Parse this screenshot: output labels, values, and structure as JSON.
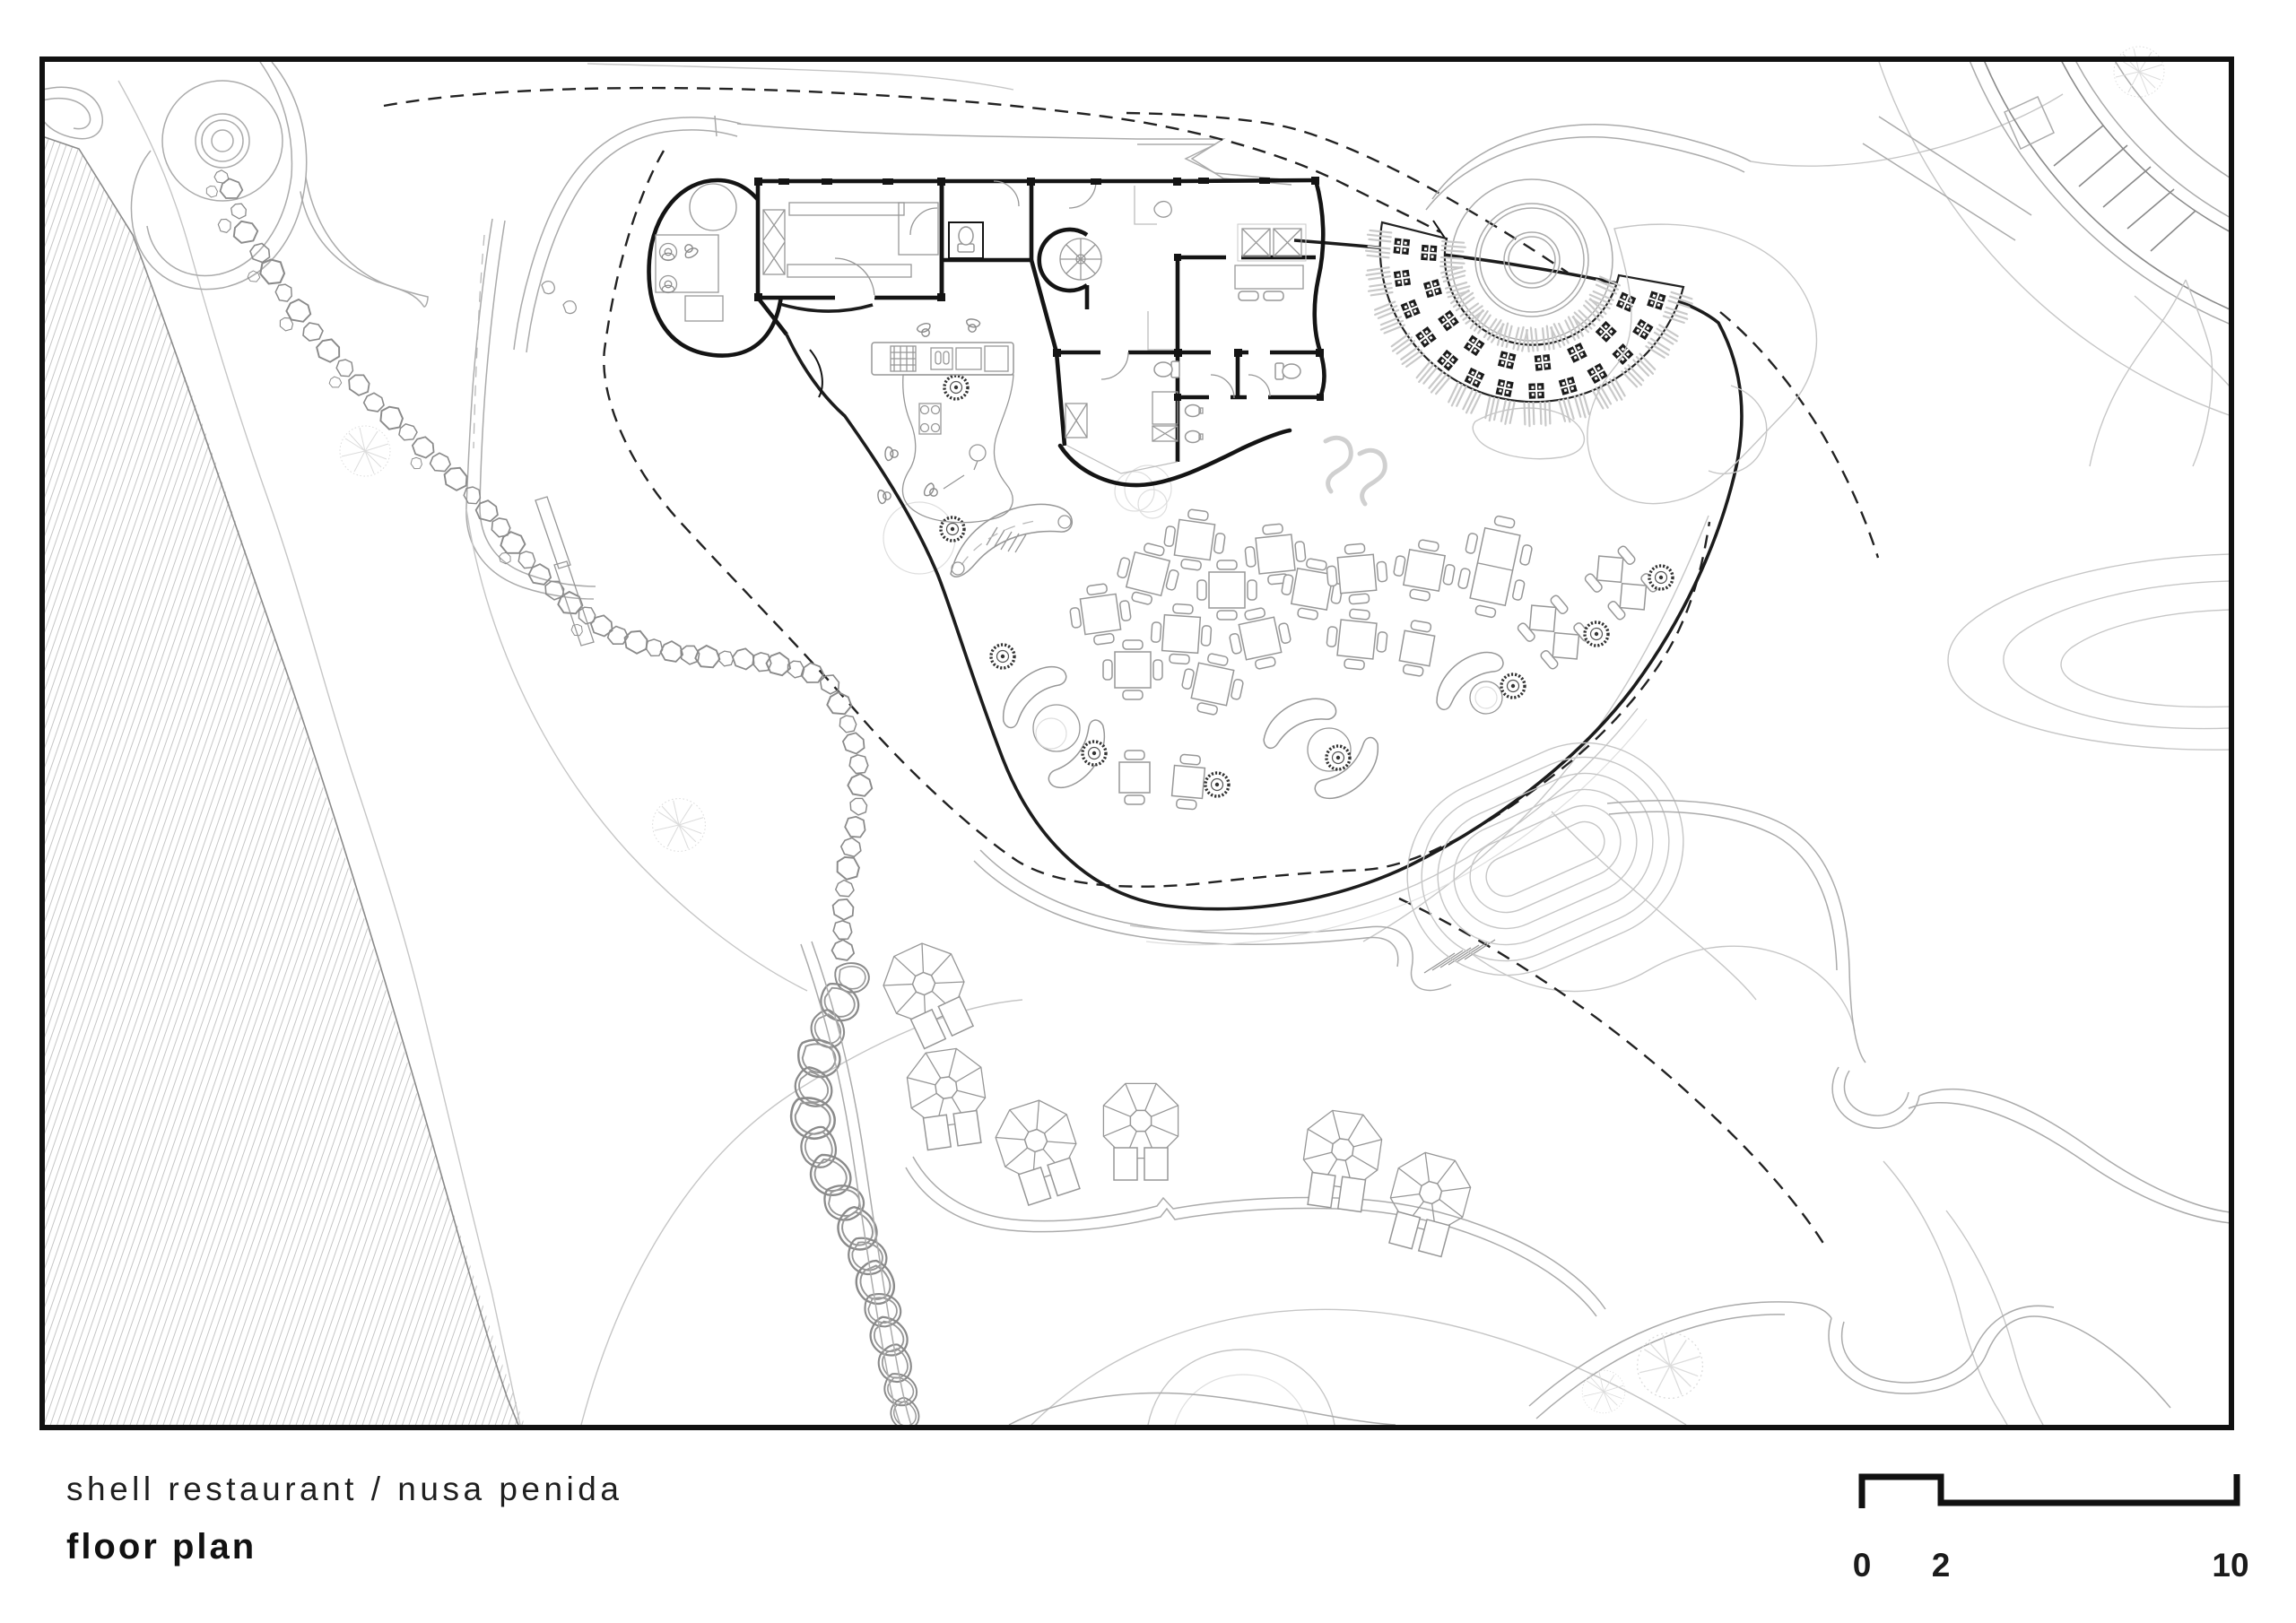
{
  "title_block": {
    "project": "shell restaurant / nusa penida",
    "drawing": "floor plan"
  },
  "scale_bar": {
    "ticks": [
      {
        "label": "0"
      },
      {
        "label": "2"
      },
      {
        "label": "10"
      }
    ]
  },
  "palette": {
    "paper": "#ffffff",
    "ink": "#141414",
    "boundary": "#1c1c1c",
    "furniture": "#979797",
    "road": "#ababab",
    "contour": "#c6c6c6",
    "faint": "#dedede",
    "dark_fill": "#1b1b1b"
  }
}
